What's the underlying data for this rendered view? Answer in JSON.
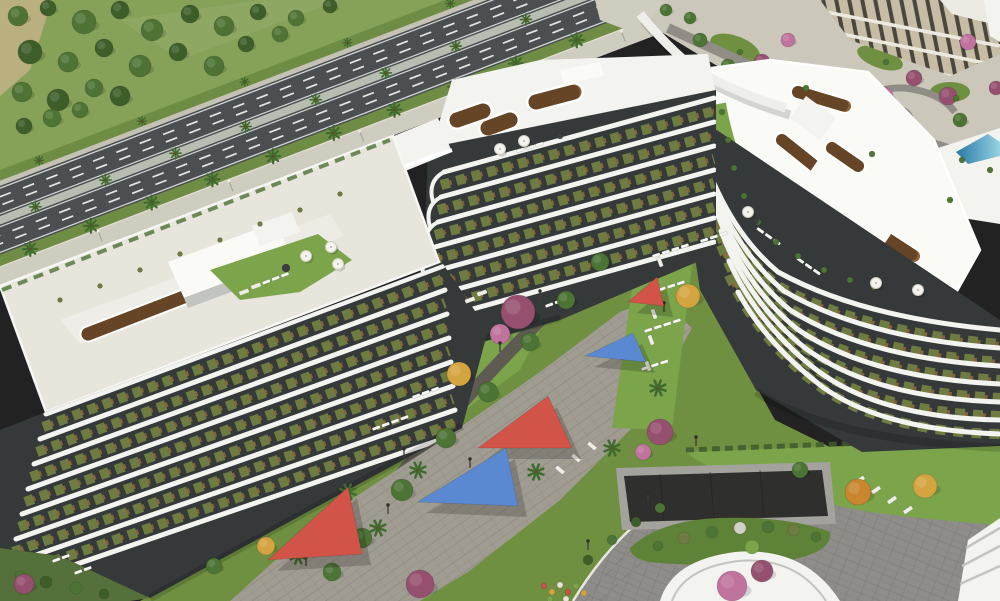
{
  "meta": {
    "canvas_width": 1000,
    "canvas_height": 601,
    "description": "aerial render of curved white residential buildings with rooftop gardens, rooftop pool, landscaped courtyard with shade sails, tree-lined highway and curved access road"
  },
  "palette": {
    "field": "#86a158",
    "dirt": "#c2b286",
    "treeA": "#4e7334",
    "treeB": "#3d5e29",
    "asphalt": "#4b4f52",
    "lane": "#e4e7e5",
    "medianC": "#b7bdb0",
    "verge": "#6f8c45",
    "sidewalk": "#cfccc0",
    "farWalk": "#c4c1b5",
    "roofL": "#e8e5dd",
    "white": "#f3f3f0",
    "whiteBright": "#fafaf7",
    "bandShad": "#c2c4bf",
    "trellis": "#8e6136",
    "trellisDark": "#46301a",
    "lawn": "#6f9040",
    "lawnB": "#7ca44b",
    "pool1": "#2878a6",
    "pool2": "#96d2e2",
    "deck": "#bd9263",
    "facDark": "#35393a",
    "facOlive": "#6f7c41",
    "facRust": "#8e6c3c",
    "plaza": "#a09c91",
    "plazaD": "#87847a",
    "walkDark": "#5e5b53",
    "roadBR": "#8e8d89",
    "roadBRline": "#7c7b77",
    "curb": "#e9e7e0",
    "island": "#5f8239",
    "ramp": "#2f2f2d",
    "rampWall": "#a3a29d",
    "sailRed": "#d25348",
    "sailBlue": "#5a89d2",
    "tPurple": "#96506f",
    "tPink": "#c0739d",
    "tYellow": "#d4a440",
    "tOrange": "#c8862f",
    "tGreen": "#4c7434",
    "palm": "#3f6b2e"
  },
  "scene": {
    "field_trees": [
      [
        18,
        16,
        10,
        "treeA"
      ],
      [
        48,
        8,
        8,
        "treeB"
      ],
      [
        84,
        22,
        12,
        "treeA"
      ],
      [
        120,
        10,
        9,
        "treeB"
      ],
      [
        152,
        30,
        11,
        "treeA"
      ],
      [
        190,
        14,
        9,
        "treeB"
      ],
      [
        224,
        26,
        10,
        "treeA"
      ],
      [
        258,
        12,
        8,
        "treeB"
      ],
      [
        296,
        18,
        8,
        "treeA"
      ],
      [
        330,
        6,
        7,
        "treeB"
      ],
      [
        30,
        52,
        12,
        "treeB"
      ],
      [
        68,
        62,
        10,
        "treeA"
      ],
      [
        104,
        48,
        9,
        "treeB"
      ],
      [
        140,
        66,
        11,
        "treeA"
      ],
      [
        178,
        52,
        9,
        "treeB"
      ],
      [
        214,
        66,
        10,
        "treeA"
      ],
      [
        246,
        44,
        8,
        "treeB"
      ],
      [
        280,
        34,
        8,
        "treeA"
      ],
      [
        22,
        92,
        10,
        "treeA"
      ],
      [
        58,
        100,
        11,
        "treeB"
      ],
      [
        94,
        88,
        9,
        "treeA"
      ],
      [
        120,
        96,
        10,
        "treeB"
      ],
      [
        52,
        118,
        9,
        "treeA"
      ],
      [
        24,
        126,
        8,
        "treeB"
      ],
      [
        80,
        110,
        8,
        "treeA"
      ]
    ],
    "road": {
      "median_palms": [
        20,
        95,
        170,
        245,
        320,
        395,
        470,
        545,
        620,
        690
      ],
      "verge_palms": [
        0,
        65,
        130,
        195,
        260,
        325,
        390,
        455,
        520,
        585,
        650,
        715
      ],
      "far_palms": [
        40,
        150,
        260,
        370,
        480,
        590
      ],
      "lights": [
        70,
        210,
        350,
        490,
        630
      ]
    },
    "tr_trees": [
      [
        762,
        62,
        8,
        "tPurple"
      ],
      [
        788,
        40,
        7,
        "tPink"
      ],
      [
        884,
        96,
        9,
        "tPink"
      ],
      [
        914,
        78,
        8,
        "tPurple"
      ],
      [
        948,
        96,
        9,
        "tPurple"
      ],
      [
        968,
        42,
        8,
        "tPink"
      ],
      [
        842,
        120,
        8,
        "tGreen"
      ],
      [
        700,
        40,
        7,
        "tGreen"
      ],
      [
        728,
        66,
        7,
        "tGreen"
      ],
      [
        960,
        120,
        7,
        "tGreen"
      ],
      [
        996,
        88,
        7,
        "tPurple"
      ],
      [
        690,
        18,
        6,
        "tGreen"
      ],
      [
        666,
        10,
        6,
        "tGreen"
      ]
    ],
    "courtyard_trees": [
      [
        518,
        312,
        17,
        "tPurple"
      ],
      [
        500,
        334,
        10,
        "tPink"
      ],
      [
        459,
        374,
        12,
        "tYellow"
      ],
      [
        688,
        296,
        12,
        "tYellow"
      ],
      [
        660,
        432,
        13,
        "tPurple"
      ],
      [
        643,
        452,
        8,
        "tPink"
      ],
      [
        732,
        586,
        15,
        "tPink"
      ],
      [
        762,
        571,
        11,
        "tPurple"
      ],
      [
        420,
        584,
        14,
        "tPurple"
      ],
      [
        858,
        492,
        13,
        "tOrange"
      ],
      [
        925,
        486,
        12,
        "tYellow"
      ],
      [
        800,
        470,
        8,
        "tGreen"
      ],
      [
        600,
        262,
        9,
        "tGreen"
      ],
      [
        566,
        300,
        9,
        "tGreen"
      ],
      [
        530,
        342,
        9,
        "tGreen"
      ],
      [
        488,
        392,
        10,
        "tGreen"
      ],
      [
        446,
        438,
        10,
        "tGreen"
      ],
      [
        402,
        490,
        11,
        "tGreen"
      ],
      [
        362,
        538,
        10,
        "tGreen"
      ],
      [
        332,
        572,
        9,
        "tGreen"
      ],
      [
        24,
        584,
        10,
        "tPurple"
      ],
      [
        266,
        546,
        9,
        "tYellow"
      ],
      [
        214,
        566,
        8,
        "tGreen"
      ]
    ],
    "plaza_palms": [
      [
        348,
        492
      ],
      [
        378,
        528
      ],
      [
        536,
        472
      ],
      [
        612,
        448
      ],
      [
        658,
        388
      ],
      [
        298,
        556
      ],
      [
        418,
        470
      ]
    ],
    "lamps": [
      [
        306,
        566
      ],
      [
        388,
        514
      ],
      [
        470,
        468
      ],
      [
        552,
        420
      ],
      [
        622,
        360
      ],
      [
        664,
        312
      ],
      [
        696,
        446
      ],
      [
        648,
        502
      ],
      [
        588,
        550
      ],
      [
        540,
        300
      ],
      [
        500,
        352
      ],
      [
        448,
        406
      ],
      [
        404,
        458
      ]
    ],
    "umbrellas": [
      [
        500,
        149
      ],
      [
        524,
        141
      ],
      [
        306,
        256
      ],
      [
        331,
        247
      ],
      [
        338,
        264
      ],
      [
        748,
        212
      ],
      [
        876,
        283
      ],
      [
        918,
        290
      ]
    ],
    "sails": [
      {
        "name": "shade-sail-red-small",
        "color": "sailRed",
        "points": "628,302 657,277 664,306"
      },
      {
        "name": "shade-sail-blue-small",
        "color": "sailBlue",
        "points": "585,356 633,333 646,362"
      },
      {
        "name": "shade-sail-red-mid",
        "color": "sailRed",
        "points": "478,448 548,396 572,448"
      },
      {
        "name": "shade-sail-blue-mid",
        "color": "sailBlue",
        "points": "418,502 506,448 518,506"
      },
      {
        "name": "shade-sail-red-large",
        "color": "sailRed",
        "points": "268,560 348,487 362,554"
      }
    ],
    "lounger_groups": [
      [
        652,
        255,
        4,
        -18
      ],
      [
        648,
        292,
        4,
        -18
      ],
      [
        644,
        330,
        4,
        -18
      ],
      [
        641,
        368,
        3,
        -18
      ],
      [
        545,
        305,
        3,
        -20
      ],
      [
        372,
        428,
        4,
        -20
      ],
      [
        412,
        396,
        3,
        -20
      ],
      [
        52,
        560,
        2,
        -20
      ],
      [
        74,
        572,
        2,
        -20
      ],
      [
        262,
        282,
        3,
        -21
      ],
      [
        758,
        227,
        3,
        35
      ],
      [
        798,
        257,
        3,
        35
      ],
      [
        516,
        150,
        3,
        -17
      ],
      [
        700,
        240,
        3,
        -18
      ]
    ],
    "stones": [
      [
        660,
        262,
        70
      ],
      [
        657,
        288,
        70
      ],
      [
        654,
        314,
        70
      ],
      [
        651,
        340,
        70
      ],
      [
        648,
        366,
        70
      ],
      [
        560,
        470,
        40
      ],
      [
        576,
        458,
        40
      ],
      [
        592,
        446,
        40
      ],
      [
        860,
        480,
        -35
      ],
      [
        876,
        490,
        -35
      ],
      [
        892,
        500,
        -35
      ],
      [
        908,
        510,
        -35
      ],
      [
        470,
        300,
        -20
      ],
      [
        482,
        293,
        -20
      ],
      [
        244,
        292,
        -20
      ],
      [
        256,
        286,
        -20
      ]
    ],
    "bushes": [
      [
        658,
        546,
        5,
        "tGreen"
      ],
      [
        684,
        538,
        6,
        "facOlive"
      ],
      [
        712,
        532,
        6,
        "tGreen"
      ],
      [
        740,
        528,
        6,
        "#cfd2c4"
      ],
      [
        768,
        527,
        6,
        "tGreen"
      ],
      [
        794,
        530,
        6,
        "facOlive"
      ],
      [
        816,
        537,
        5,
        "tGreen"
      ],
      [
        752,
        547,
        7,
        "lawnB"
      ],
      [
        722,
        112,
        3,
        "tGreen"
      ],
      [
        728,
        140,
        3,
        "tGreen"
      ],
      [
        734,
        168,
        3,
        "tGreen"
      ],
      [
        744,
        196,
        3,
        "tGreen"
      ],
      [
        758,
        222,
        3,
        "tGreen"
      ],
      [
        776,
        242,
        3,
        "tGreen"
      ],
      [
        798,
        256,
        3,
        "tGreen"
      ],
      [
        824,
        270,
        3,
        "tGreen"
      ],
      [
        850,
        280,
        3,
        "tGreen"
      ],
      [
        874,
        287,
        3,
        "tGreen"
      ],
      [
        60,
        300,
        2.5,
        "facOlive"
      ],
      [
        100,
        286,
        2.5,
        "facOlive"
      ],
      [
        140,
        270,
        2.5,
        "facOlive"
      ],
      [
        180,
        254,
        2.5,
        "facOlive"
      ],
      [
        220,
        240,
        2.5,
        "facOlive"
      ],
      [
        260,
        224,
        2.5,
        "facOlive"
      ],
      [
        300,
        210,
        2.5,
        "facOlive"
      ],
      [
        340,
        194,
        2.5,
        "facOlive"
      ],
      [
        740,
        52,
        3,
        "tGreen"
      ],
      [
        806,
        88,
        3,
        "tGreen"
      ],
      [
        886,
        62,
        3,
        "tGreen"
      ],
      [
        956,
        98,
        3,
        "tGreen"
      ],
      [
        872,
        154,
        3,
        "tGreen"
      ],
      [
        286,
        268,
        4,
        "#3a3e40"
      ],
      [
        492,
        145,
        3,
        "#3a3e40"
      ],
      [
        756,
        221,
        3,
        "#3a3e40"
      ],
      [
        880,
        287,
        3,
        "#3a3e40"
      ],
      [
        560,
        136,
        3,
        "#3a3e40"
      ],
      [
        20,
        576,
        5,
        "tGreen"
      ],
      [
        46,
        582,
        6,
        "treeB"
      ],
      [
        76,
        588,
        6,
        "tGreen"
      ],
      [
        104,
        594,
        5,
        "treeB"
      ],
      [
        588,
        560,
        5,
        "treeB"
      ],
      [
        612,
        540,
        5,
        "tGreen"
      ],
      [
        636,
        522,
        5,
        "treeB"
      ],
      [
        660,
        508,
        5,
        "tGreen"
      ],
      [
        544,
        586,
        3,
        "#c05548"
      ],
      [
        552,
        592,
        3,
        "#d4a440"
      ],
      [
        560,
        585,
        3,
        "#e7e3d6"
      ],
      [
        568,
        592,
        3,
        "#c05548"
      ],
      [
        576,
        586,
        3,
        "#7ca44b"
      ],
      [
        584,
        593,
        3,
        "#d4a440"
      ],
      [
        550,
        599,
        3,
        "#7ca44b"
      ],
      [
        566,
        599,
        3,
        "#e7e3d6"
      ],
      [
        962,
        160,
        3,
        "tGreen"
      ],
      [
        990,
        170,
        3,
        "tGreen"
      ],
      [
        950,
        200,
        3,
        "tGreen"
      ]
    ],
    "facades": {
      "left": {
        "n": 8,
        "sx": 46,
        "sy": 414,
        "ex": 443,
        "ey": 266,
        "dsx": -6,
        "dsy": 25,
        "dex": 2,
        "dey": 24
      },
      "center": {
        "n": 7,
        "sx": 444,
        "sy": 172,
        "ex": 714,
        "ey": 98,
        "dsx": -3,
        "dsy": 25,
        "dex": 0,
        "dey": 24,
        "corner_arcs": 6
      },
      "right": {
        "band_paths": [
          "M692,118 Q718,222 778,272 Q862,318 1000,330",
          "M699,146 Q725,242 784,291 Q864,338 1000,348",
          "M706,174 Q732,262 790,310 Q866,358 1000,366",
          "M713,202 Q740,282 797,329 Q869,378 1000,384",
          "M721,231 Q748,302 805,348 Q873,398 1000,402",
          "M729,261 Q757,323 814,368 Q878,418 1000,420",
          "M738,292 Q767,345 824,388 Q884,430 1000,434"
        ]
      }
    }
  }
}
